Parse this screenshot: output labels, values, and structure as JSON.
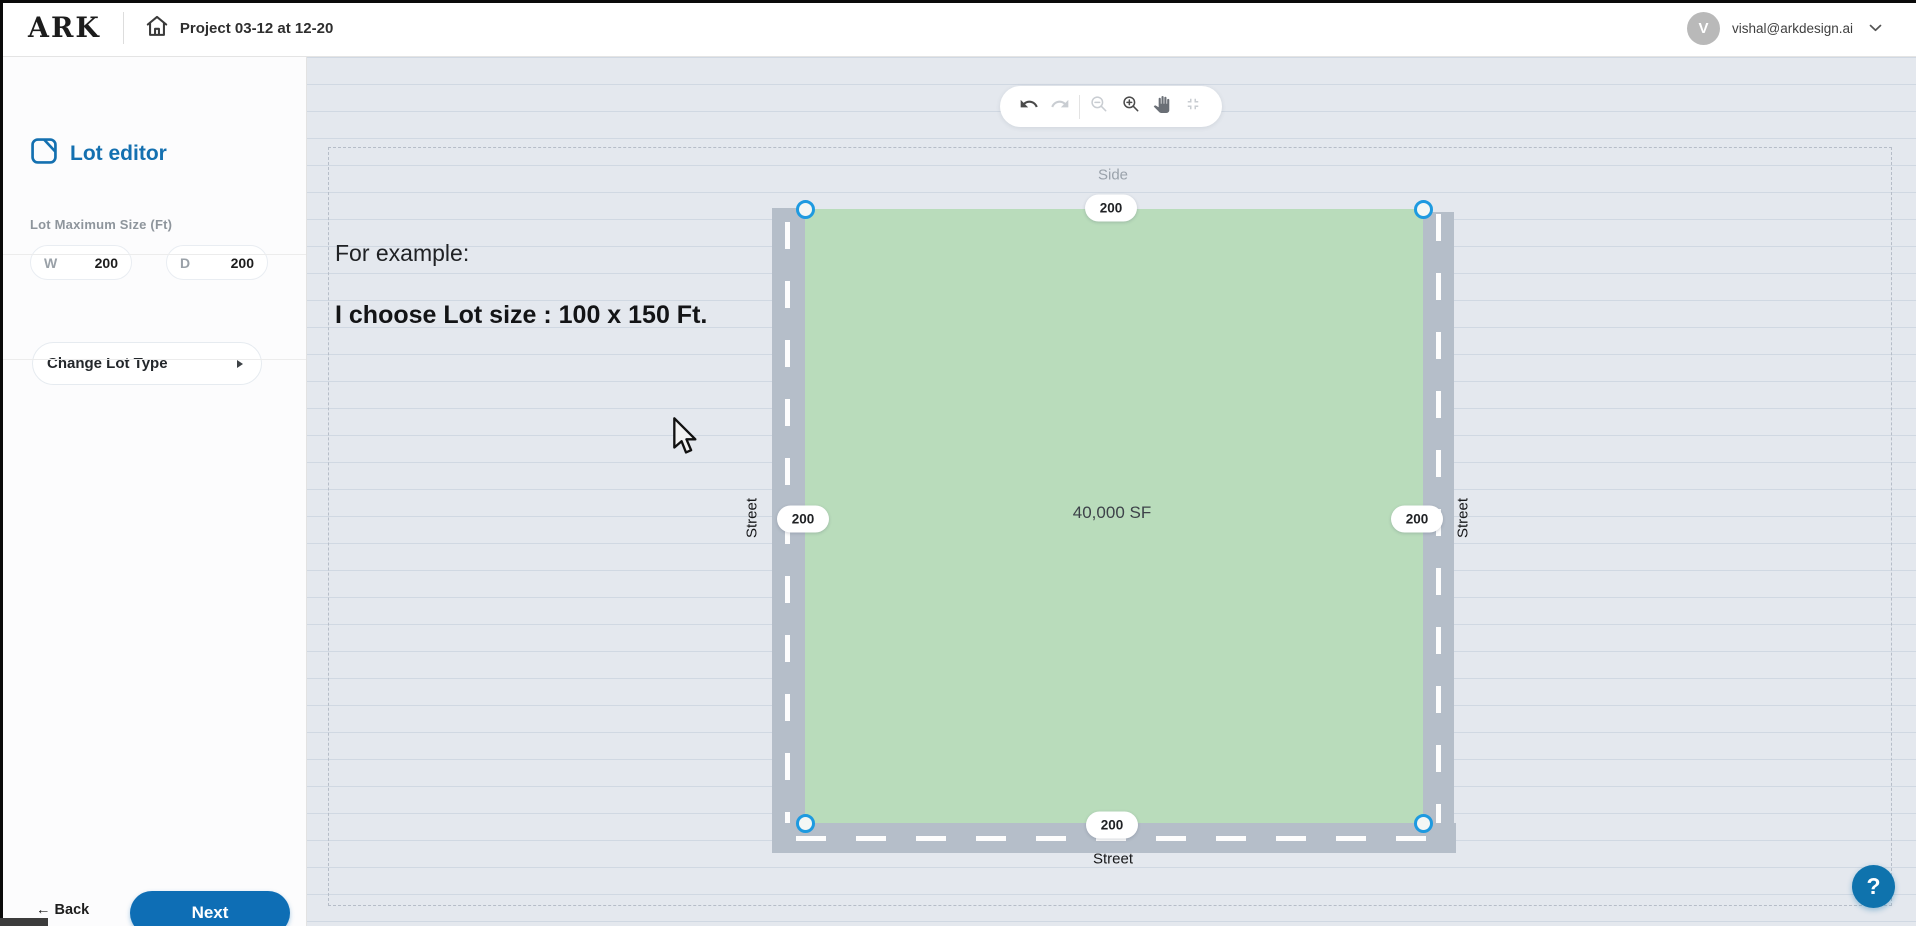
{
  "header": {
    "logo": "ARK",
    "project_title": "Project 03-12 at 12-20",
    "avatar_initial": "V",
    "user_email": "vishal@arkdesign.ai"
  },
  "sidebar": {
    "title": "Lot editor",
    "section_label": "Lot Maximum Size (Ft)",
    "width_field": {
      "label": "W",
      "value": "200"
    },
    "depth_field": {
      "label": "D",
      "value": "200"
    },
    "change_lot_type_label": "Change Lot Type",
    "back_label": "← Back",
    "next_label": "Next"
  },
  "toolbar": {
    "icons": [
      "undo",
      "redo",
      "zoom-out",
      "zoom-in",
      "pan-hand",
      "fit-to-screen"
    ]
  },
  "canvas": {
    "example_line1": "For example:",
    "example_line2": "I choose Lot size : 100 x 150 Ft.",
    "lot": {
      "area_label": "40,000 SF",
      "top_label": "Side",
      "left_label": "Street",
      "right_label": "Street",
      "bottom_label": "Street",
      "dim_top": "200",
      "dim_left": "200",
      "dim_right": "200",
      "dim_bottom": "200"
    }
  },
  "help": {
    "label": "?"
  },
  "colors": {
    "accent_blue": "#0e6eb5",
    "handle_blue": "#1e9ae0",
    "lot_fill_green": "#b9dcbb",
    "road_gray": "#b5bec9",
    "canvas_bg": "#e4e8ee",
    "help_blue": "#0f73ad",
    "avatar_gray": "#b9b9b9"
  }
}
